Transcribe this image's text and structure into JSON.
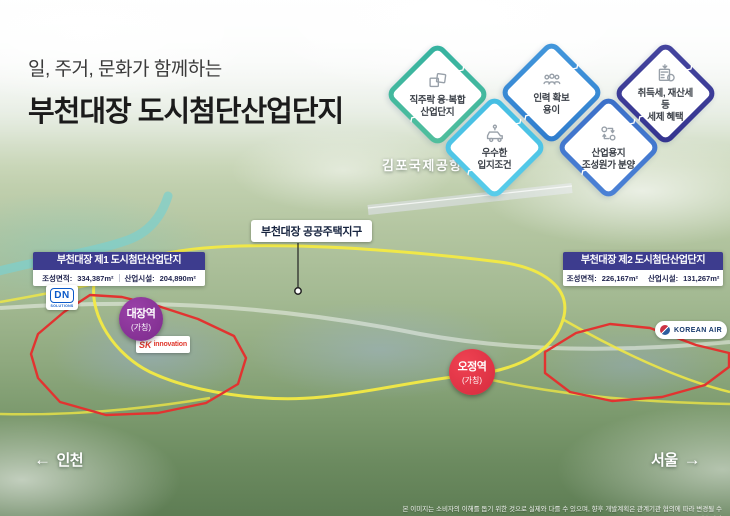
{
  "header": {
    "subtitle": "일, 주거, 문화가 함께하는",
    "title": "부천대장 도시첨단산업단지"
  },
  "benefit_diamonds": [
    {
      "icon": "puzzle-icon",
      "line1": "직주락 융·복합",
      "line2": "산업단지",
      "border_color": "#35b2a0"
    },
    {
      "icon": "people-icon",
      "line1": "인력 확보",
      "line2": "용이",
      "border_color": "#3e8ed8"
    },
    {
      "icon": "tax-benefit-icon",
      "line1": "취득세, 재산세 등",
      "line2": "세제 혜택",
      "border_color": "#3d3f9e"
    },
    {
      "icon": "car-location-icon",
      "line1": "우수한",
      "line2": "입지조건",
      "border_color": "#45bde2"
    },
    {
      "icon": "cost-transfer-icon",
      "line1": "산업용지",
      "line2": "조성원가 분양",
      "border_color": "#3a6fc8"
    }
  ],
  "map": {
    "airport_label": "김포국제공항",
    "housing_district_label": "부천대장 공공주택지구",
    "complex1": {
      "title": "부천대장 제1 도시첨단산업단지",
      "area_label": "조성면적:",
      "area_value": "334,387m²",
      "facility_label": "산업시설:",
      "facility_value": "204,890m²"
    },
    "complex2": {
      "title": "부천대장 제2 도시첨단산업단지",
      "area_label": "조성면적:",
      "area_value": "226,167m²",
      "facility_label": "산업시설:",
      "facility_value": "131,267m²"
    },
    "stations": [
      {
        "name": "대장역",
        "sub": "(가칭)",
        "color": "#7c2b8c"
      },
      {
        "name": "오정역",
        "sub": "(가칭)",
        "color": "#d62b3e"
      }
    ],
    "logos": {
      "dn": {
        "text": "DN",
        "sub": "SOLUTIONS"
      },
      "sk": {
        "text": "SK",
        "sub": "innovation"
      },
      "korean_air": {
        "text": "KOREAN AIR"
      }
    },
    "directions": {
      "west_arrow": "←",
      "west_label": "인천",
      "east_label": "서울",
      "east_arrow": "→"
    }
  },
  "footer": {
    "disclaimer": "본 이미지는 소비자의 이해를 돕기 위한 것으로 실제와 다를 수 있으며, 향후 개발계획은 관계기관 협의에 따라 변경될 수 있습니다"
  },
  "colors": {
    "callout_header": "#3d3c8e",
    "district_boundary_red": "#e23330",
    "housing_boundary_yellow": "#f3ea43",
    "station_daejang_purple": "#7c2b8c",
    "station_ojeong_red": "#d62b3e"
  }
}
